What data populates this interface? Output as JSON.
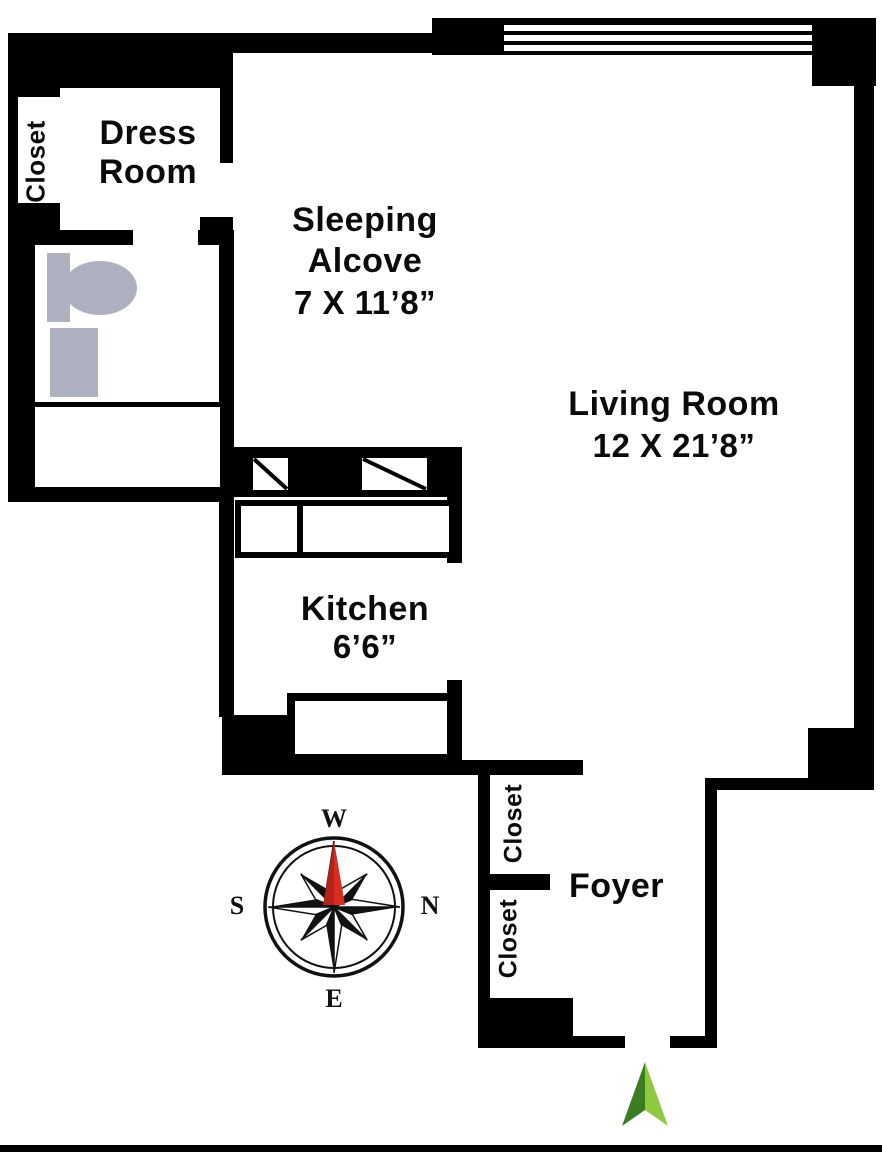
{
  "plan": {
    "rooms": {
      "dress_room": {
        "name_line1": "Dress",
        "name_line2": "Room"
      },
      "sleeping_alcove": {
        "name_line1": "Sleeping",
        "name_line2": "Alcove",
        "dimensions": "7 X 11’8”"
      },
      "living_room": {
        "name": "Living Room",
        "dimensions": "12 X 21’8”"
      },
      "kitchen": {
        "name": "Kitchen",
        "dimensions": "6’6”"
      },
      "foyer": {
        "name": "Foyer"
      },
      "closet_left": {
        "name": "Closet"
      },
      "closet_foyer_upper": {
        "name": "Closet"
      },
      "closet_foyer_lower": {
        "name": "Closet"
      }
    },
    "compass": {
      "top": "W",
      "right": "N",
      "bottom": "E",
      "left": "S"
    },
    "colors": {
      "wall_black": "#000000",
      "fixture_gray": "#aeb1c0",
      "compass_needle_red": "#cf2a1e",
      "entry_arrow_dark_green": "#3a7d23",
      "entry_arrow_light_green": "#8fc93f"
    }
  }
}
